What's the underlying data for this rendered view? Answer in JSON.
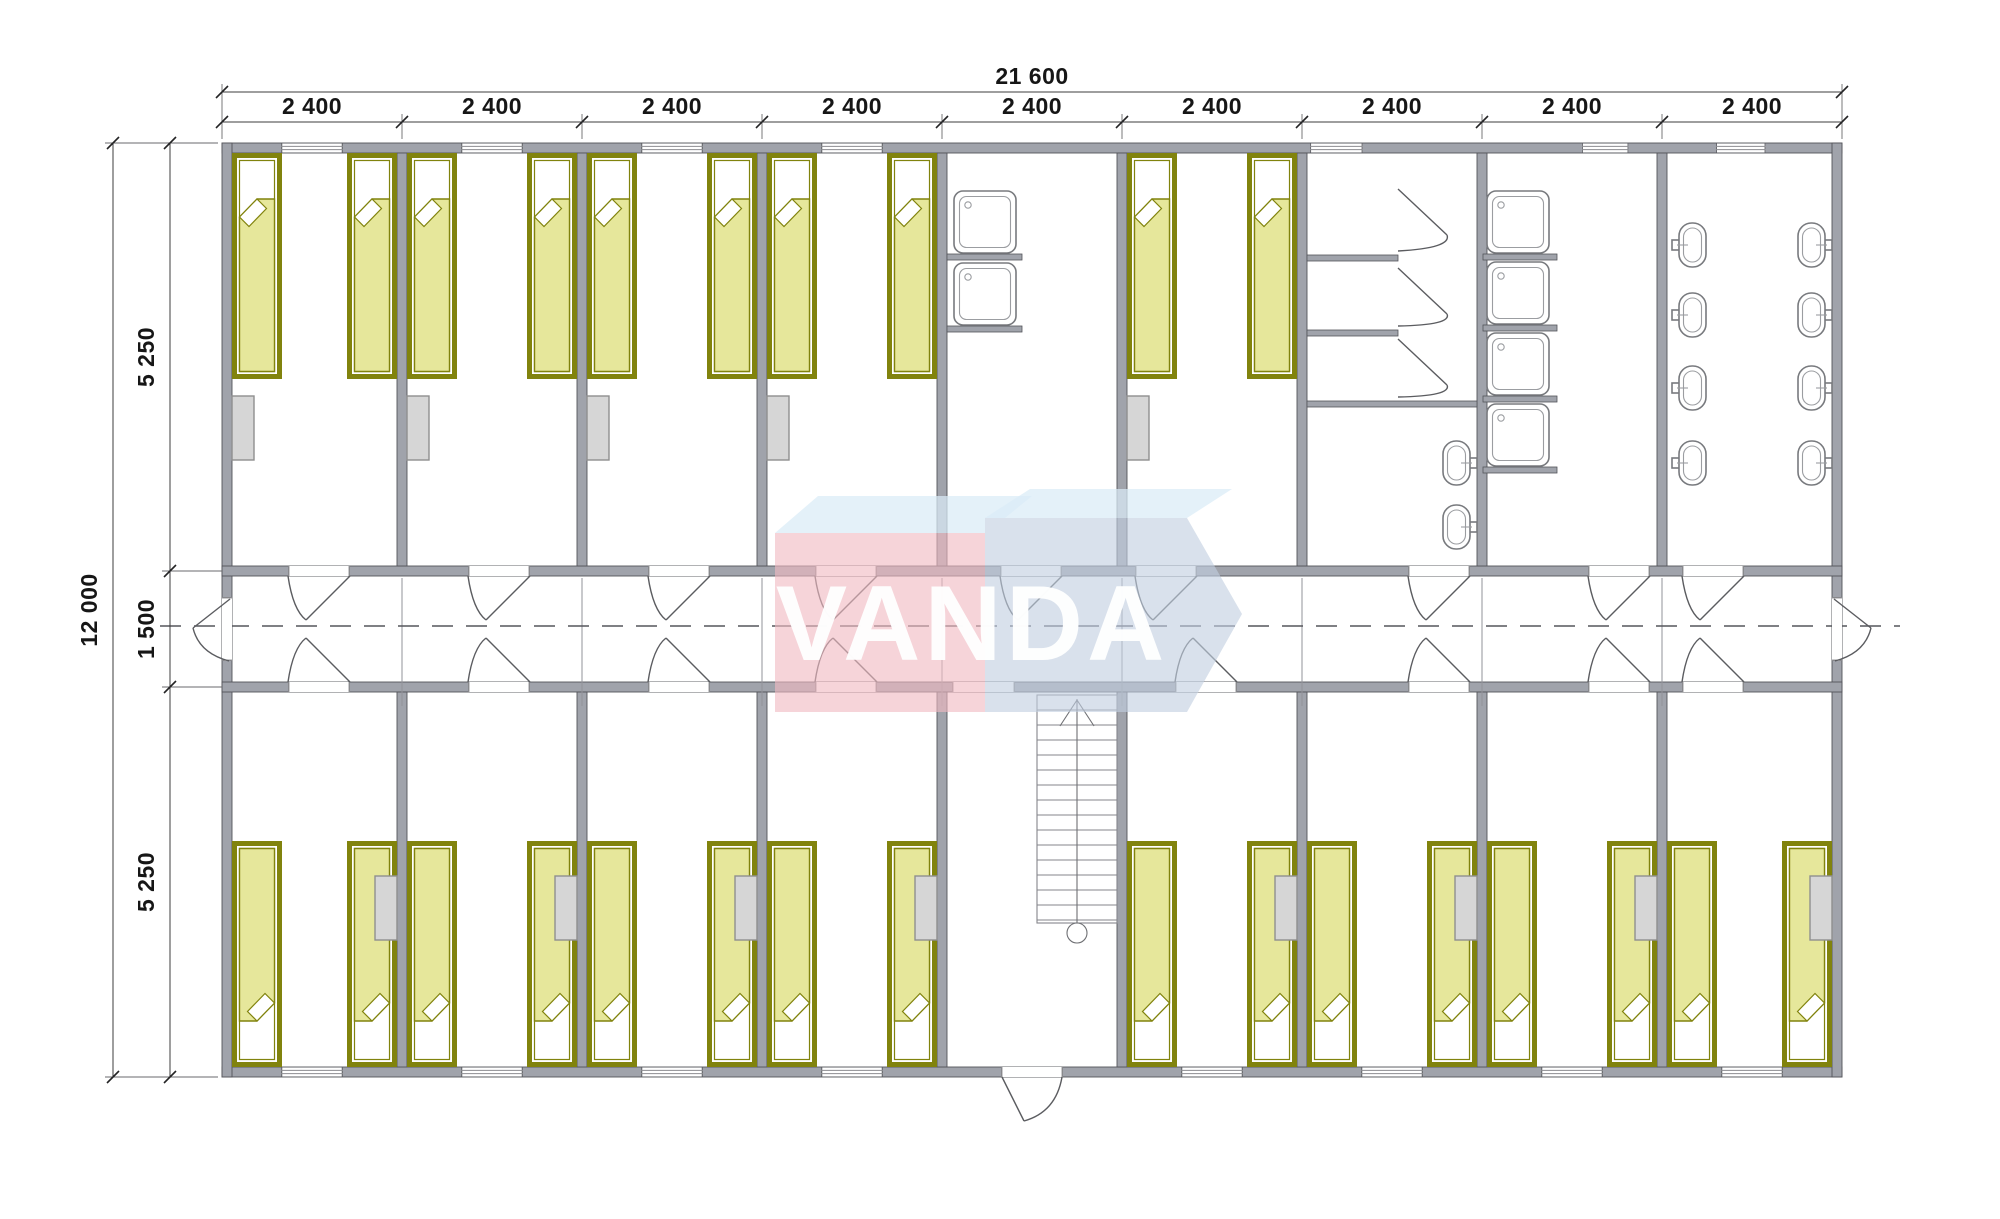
{
  "watermark": {
    "text": "VANDA"
  },
  "dimensions": {
    "top_total": "21 600",
    "top_modules": [
      "2 400",
      "2 400",
      "2 400",
      "2 400",
      "2 400",
      "2 400",
      "2 400",
      "2 400",
      "2 400"
    ],
    "left_total": "12 000",
    "left_segments": [
      "5 250",
      "1 500",
      "5 250"
    ]
  },
  "inventory": {
    "modules": 9,
    "bedrooms": 13,
    "beds": 26,
    "wardrobes": 13,
    "shower_trays": 6,
    "toilet_stalls": 3,
    "wash_basins": 10,
    "staircases": 1
  },
  "colors": {
    "wall": "#a0a3ab",
    "wall_edge": "#53545a",
    "bed_frame": "#81830d",
    "bed_fill": "#e6e79b",
    "cabinet": "#d6d6d6",
    "cabinet_edge": "#8f8f8f",
    "fixture": "#787a7e",
    "dim_text": "#161616",
    "wm_red": "#f0b9c2",
    "wm_blue": "#c2cfe0",
    "wm_top": "#d9ecf6",
    "wm_text": "#ffffff"
  }
}
